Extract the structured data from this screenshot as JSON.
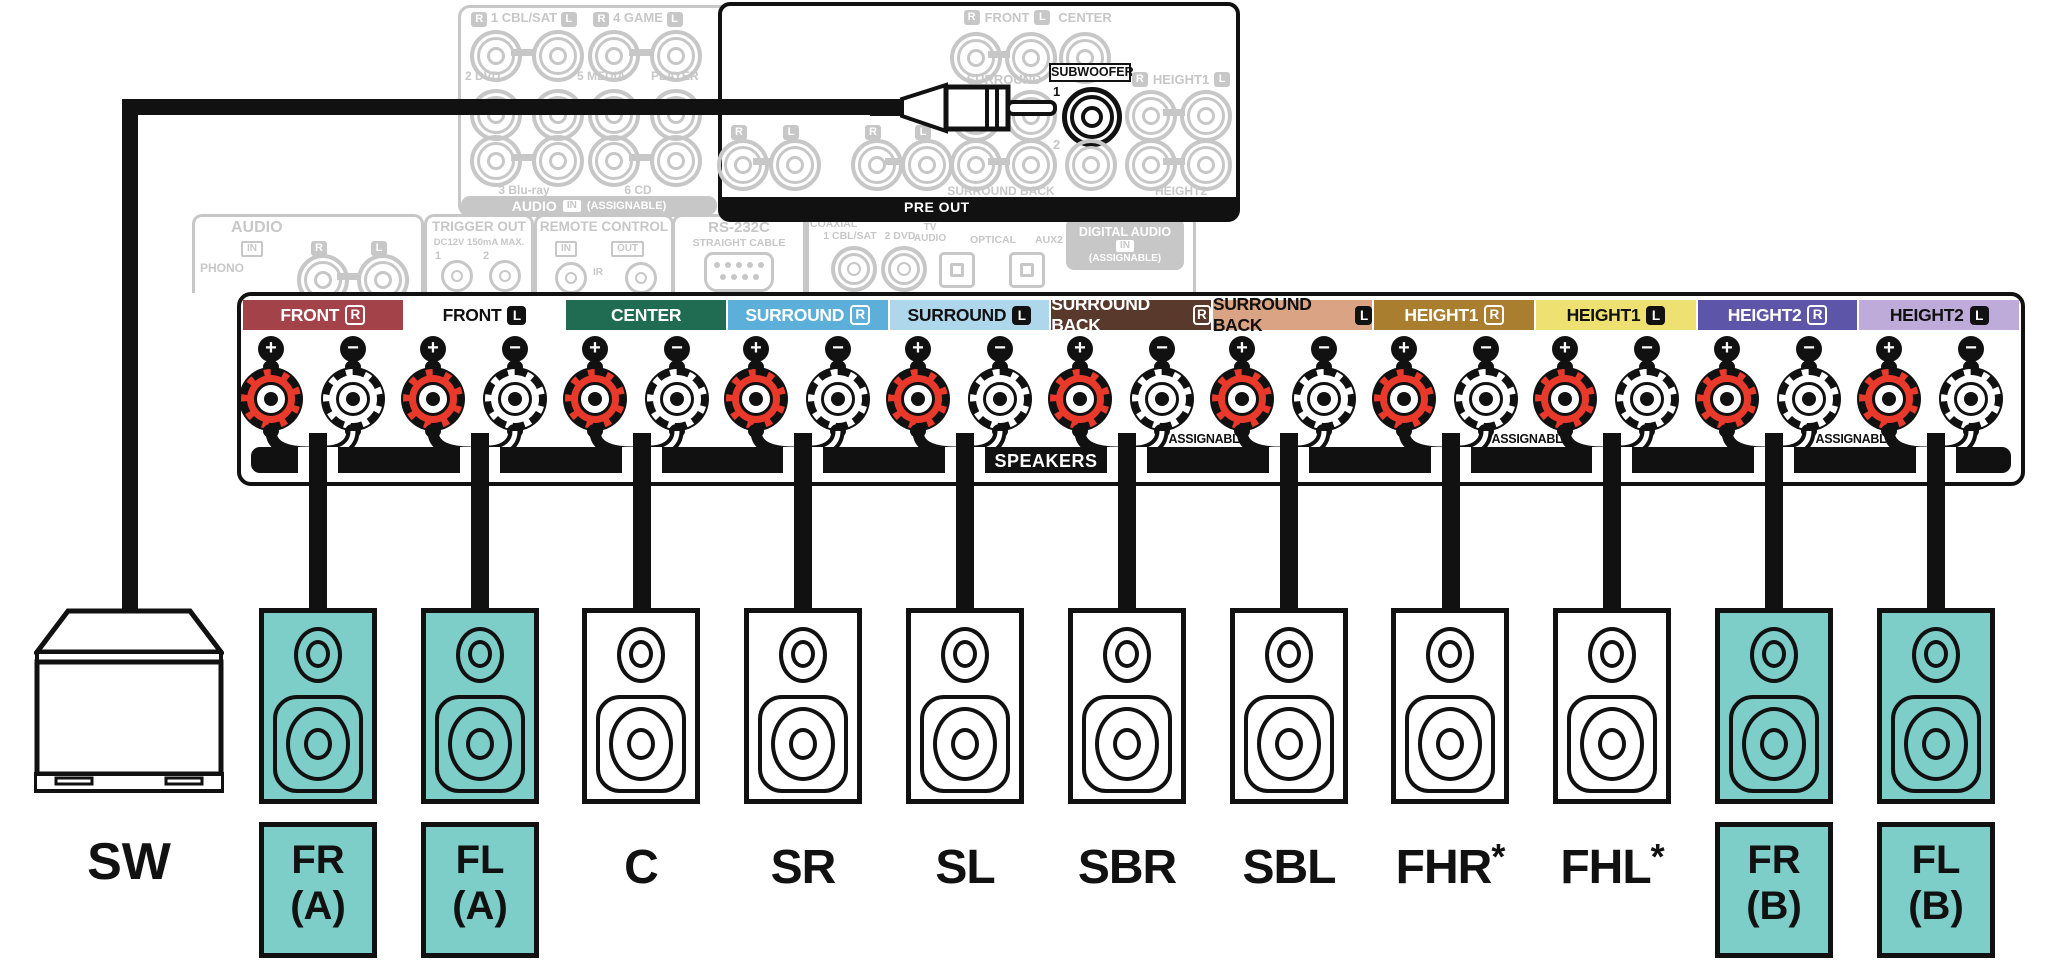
{
  "colors": {
    "teal": "#7DCDC8",
    "post_red": "#E8392B",
    "faded_gray": "#C7C7C7"
  },
  "pre_out": {
    "bar_label": "PRE OUT",
    "subwoofer": "SUBWOOFER",
    "one": "1",
    "two": "2",
    "r": "R",
    "l": "L",
    "front": "FRONT",
    "center": "CENTER",
    "surround": "SURROUND",
    "surround_back": "SURROUND BACK",
    "height1": "HEIGHT1",
    "height2": "HEIGHT2"
  },
  "panel_audio_in": {
    "title": "AUDIO",
    "badge_in": "IN",
    "assignable": "(ASSIGNABLE)",
    "r": "R",
    "l": "L",
    "row1_left": "1 CBL/SAT",
    "row1_right": "4 GAME",
    "row2_a": "2 DVD",
    "row2_b": "5 MEDIA",
    "row2_c": "PLAYER",
    "row3_a": "3 Blu-ray",
    "row3_b": "6 CD"
  },
  "mini_panels": {
    "phono": {
      "title": "AUDIO",
      "badge_in": "IN",
      "r": "R",
      "l": "L",
      "label": "PHONO"
    },
    "trigger": {
      "title": "TRIGGER OUT",
      "subtitle": "DC12V 150mA MAX.",
      "one": "1",
      "two": "2"
    },
    "remote": {
      "title": "REMOTE CONTROL",
      "in": "IN",
      "out": "OUT",
      "ir": "IR"
    },
    "rs232c": {
      "title": "RS-232C",
      "subtitle": "STRAIGHT CABLE"
    },
    "digital": {
      "coaxial": "COAXIAL",
      "jack1": "1 CBL/SAT",
      "jack2": "2 DVD",
      "tv1": "TV",
      "tv2": "AUDIO",
      "optical": "OPTICAL",
      "aux": "AUX2",
      "title": "DIGITAL AUDIO",
      "badge_in": "IN",
      "assignable": "(ASSIGNABLE)"
    }
  },
  "strip": {
    "speakers_label": "SPEAKERS",
    "assignable_label": "ASSIGNABLE",
    "plus": "+",
    "minus": "−",
    "sections": [
      {
        "label": "FRONT",
        "letter": "R",
        "bg": "#A4424A"
      },
      {
        "label": "FRONT",
        "letter": "L",
        "bg": ""
      },
      {
        "label": "CENTER",
        "letter": "",
        "bg": "#206C52"
      },
      {
        "label": "SURROUND",
        "letter": "R",
        "bg": "#5BAFD9"
      },
      {
        "label": "SURROUND",
        "letter": "L",
        "bg": "#AFD7EC"
      },
      {
        "label": "SURROUND BACK",
        "letter": "R",
        "bg": "#59392B"
      },
      {
        "label": "SURROUND BACK",
        "letter": "L",
        "bg": "#D9A384"
      },
      {
        "label": "HEIGHT1",
        "letter": "R",
        "bg": "#A97E2F"
      },
      {
        "label": "HEIGHT1",
        "letter": "L",
        "bg": "#EFE171"
      },
      {
        "label": "HEIGHT2",
        "letter": "R",
        "bg": "#5D55A7"
      },
      {
        "label": "HEIGHT2",
        "letter": "L",
        "bg": "#BEABD9"
      }
    ]
  },
  "speakers": {
    "sw": "SW",
    "items": [
      {
        "line1": "FR",
        "line2": "(A)"
      },
      {
        "line1": "FL",
        "line2": "(A)"
      },
      {
        "label": "C",
        "suffix": ""
      },
      {
        "label": "SR",
        "suffix": ""
      },
      {
        "label": "SL",
        "suffix": ""
      },
      {
        "label": "SBR",
        "suffix": ""
      },
      {
        "label": "SBL",
        "suffix": ""
      },
      {
        "label": "FHR",
        "suffix": "*"
      },
      {
        "label": "FHL",
        "suffix": "*"
      },
      {
        "line1": "FR",
        "line2": "(B)"
      },
      {
        "line1": "FL",
        "line2": "(B)"
      }
    ]
  }
}
